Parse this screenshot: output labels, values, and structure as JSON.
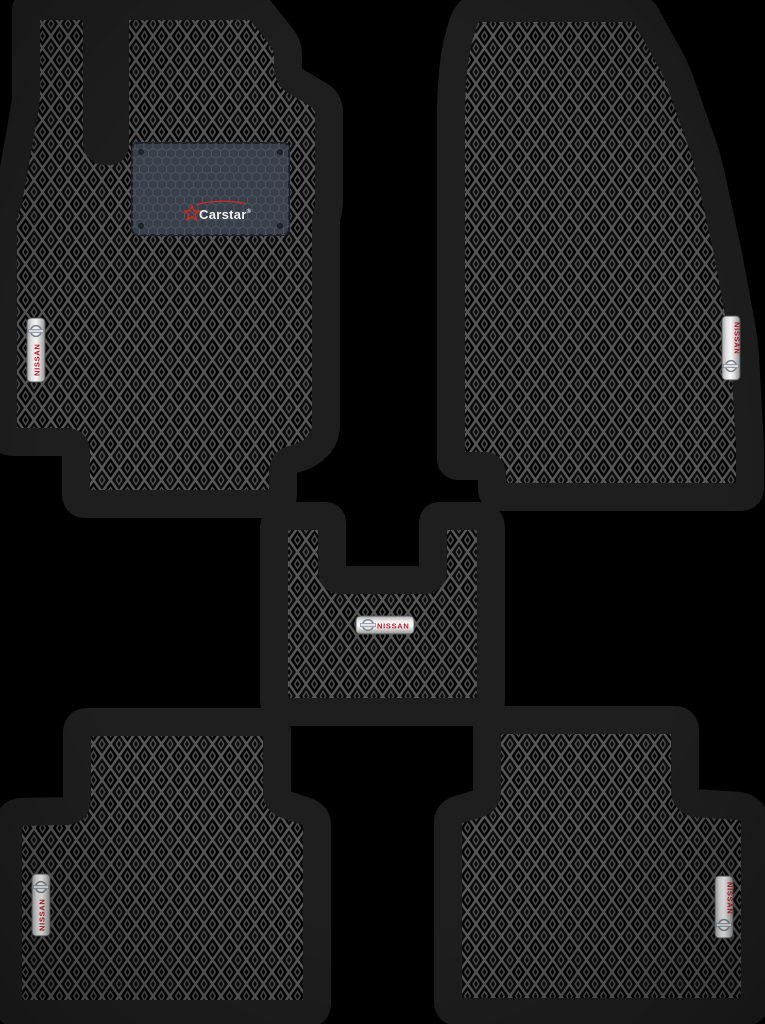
{
  "scene": {
    "type": "product-photo",
    "background_color": "#000000",
    "item_count": 5
  },
  "brand_patch": {
    "text": "Carstar",
    "registered_mark": "®",
    "text_color": "#f2f2f2",
    "accent_color": "#d02a24",
    "pad_color": "#394049"
  },
  "badge": {
    "text": "NISSAN",
    "text_color": "#bf1420",
    "plate_color": "#e8e8e8"
  },
  "pattern": {
    "cell_color": "#030303",
    "line_color": "#575757",
    "trim_color": "#1e1e1e"
  }
}
